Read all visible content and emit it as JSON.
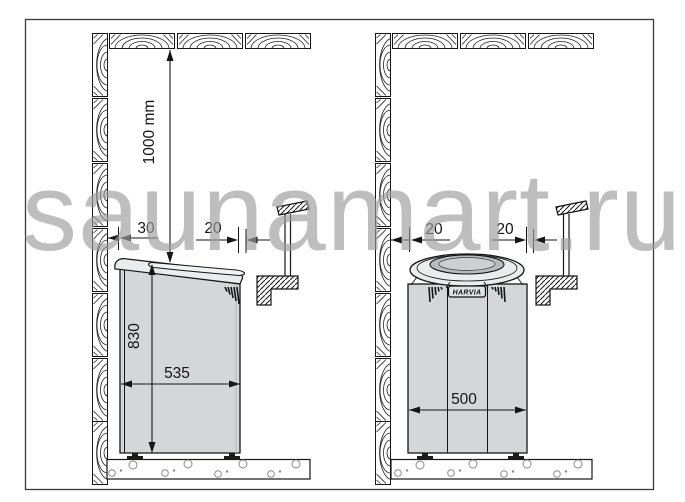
{
  "watermark": {
    "text": "saunamart.ru"
  },
  "brand": {
    "logo_label": "HARVIA"
  },
  "left_diagram": {
    "ceiling_clearance_label": "1000 mm",
    "side_wall_gap_label": "30",
    "guard_gap_label": "20",
    "heater_height_label": "830",
    "heater_width_label": "535"
  },
  "right_diagram": {
    "side_wall_gap_label": "20",
    "guard_gap_label": "20",
    "heater_width_label": "500"
  },
  "colors": {
    "outline": "#161616",
    "heater_body": "#d4d6d8",
    "heater_lid": "#ebeced",
    "stone_cavity": "#b9bbbd",
    "watermark_grey": "#c3c3c3"
  }
}
